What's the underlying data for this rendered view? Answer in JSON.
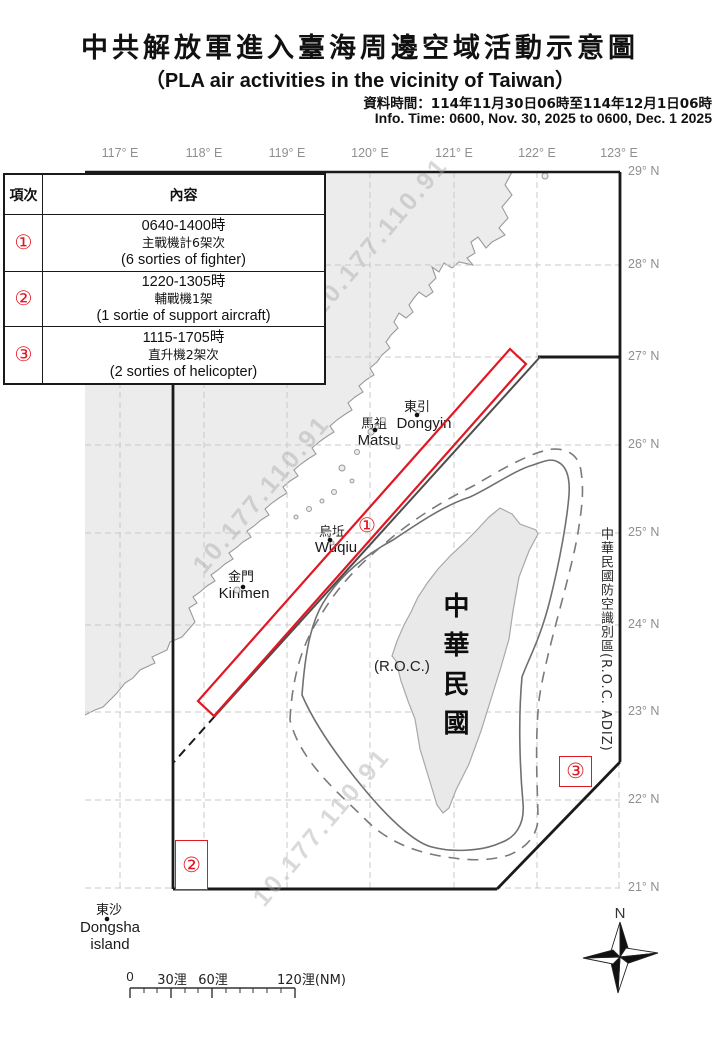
{
  "header": {
    "title_zh": "中共解放軍進入臺海周邊空域活動示意圖",
    "title_en": "（PLA air activities in the vicinity of Taiwan）",
    "info_zh": "資料時間：114年11月30日06時至114年12月1日06時",
    "info_en": "Info. Time: 0600, Nov. 30, 2025 to 0600, Dec. 1 2025"
  },
  "table": {
    "col_index": "項次",
    "col_content": "內容",
    "rows": [
      {
        "marker": "①",
        "time": "0640-1400時",
        "desc_zh": "主戰機計6架次",
        "desc_en": "(6 sorties of fighter)"
      },
      {
        "marker": "②",
        "time": "1220-1305時",
        "desc_zh": "輔戰機1架",
        "desc_en": "(1 sortie of support aircraft)"
      },
      {
        "marker": "③",
        "time": "1115-1705時",
        "desc_zh": "直升機2架次",
        "desc_en": "(2 sorties of helicopter)"
      }
    ]
  },
  "map": {
    "lon_labels": [
      "117° E",
      "118° E",
      "119° E",
      "120° E",
      "121° E",
      "122° E",
      "123° E"
    ],
    "lat_labels": [
      "29° N",
      "28° N",
      "27° N",
      "26° N",
      "25° N",
      "24° N",
      "23° N",
      "22° N",
      "21° N"
    ],
    "adiz_label": "中華民國防空識別區(R.O.C. ADIZ)",
    "roc_vertical": "中華民國",
    "roc_paren": "(R.O.C.)",
    "markers": {
      "m1": "①",
      "m2": "②",
      "m3": "③"
    },
    "places": {
      "dongyin": {
        "zh": "東引",
        "en": "Dongyin"
      },
      "matsu": {
        "zh": "馬祖",
        "en": "Matsu"
      },
      "wuqiu": {
        "zh": "烏坵",
        "en": "Wuqiu"
      },
      "kinmen": {
        "zh": "金門",
        "en": "Kinmen"
      },
      "dongsha": {
        "zh": "東沙",
        "en": "Dongsha",
        "en2": "island"
      }
    },
    "compass_n": "N",
    "watermark": "10.177.110.91",
    "colors": {
      "accent_red": "#e01824",
      "adiz_line": "#1a1a1a",
      "contour_gray": "#707070",
      "grid_gray": "#c9c9c9",
      "land_fill": "#ececec",
      "coast_gray": "#9a9a9a",
      "degree_label_gray": "#8f8f8f"
    }
  },
  "scalebar": {
    "labels": [
      "0",
      "30浬",
      "60浬",
      "120浬(NM)"
    ]
  }
}
